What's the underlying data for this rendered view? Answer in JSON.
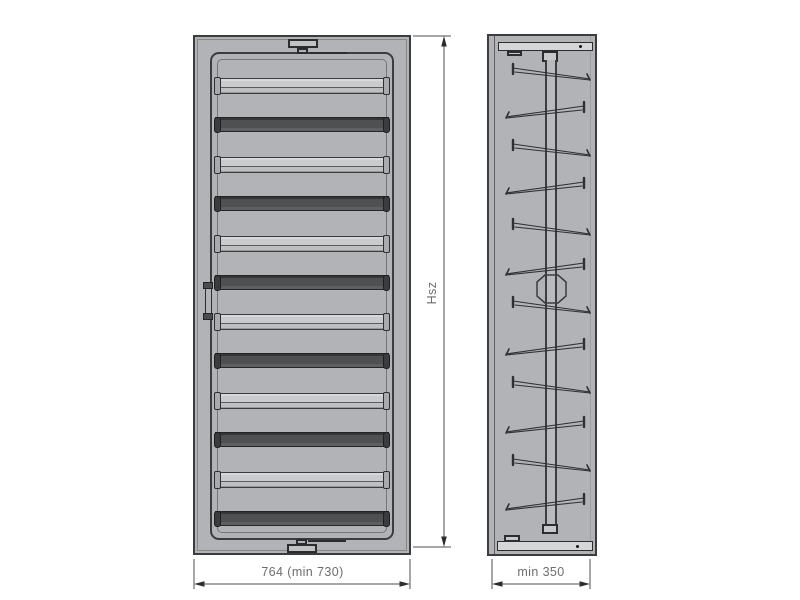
{
  "drawing": {
    "type": "technical-drawing",
    "views": {
      "front": {
        "name": "front view",
        "slat_count": 12
      },
      "side": {
        "name": "side view",
        "bracket_count": 12
      }
    },
    "labels": {
      "width": "764 (min 730)",
      "height": "Hsz",
      "depth": "min 350"
    },
    "colors": {
      "background": "#ffffff",
      "body": "#b1b3b6",
      "outline": "#3a3c3e",
      "light_slat": "#c9cbcd",
      "dark_slat": "#4e5052",
      "dimension_line": "#4d4f52",
      "label_text": "#6b6d70"
    },
    "front_view": {
      "slats": [
        {
          "y": 43,
          "type": "light"
        },
        {
          "y": 82,
          "type": "dark"
        },
        {
          "y": 122,
          "type": "light"
        },
        {
          "y": 161,
          "type": "dark"
        },
        {
          "y": 201,
          "type": "light"
        },
        {
          "y": 240,
          "type": "dark"
        },
        {
          "y": 279,
          "type": "light"
        },
        {
          "y": 318,
          "type": "dark"
        },
        {
          "y": 358,
          "type": "light"
        },
        {
          "y": 397,
          "type": "dark"
        },
        {
          "y": 437,
          "type": "light"
        },
        {
          "y": 476,
          "type": "dark"
        }
      ]
    },
    "side_view": {
      "brackets": [
        {
          "y": 33,
          "dir": "lr"
        },
        {
          "y": 71,
          "dir": "rl"
        },
        {
          "y": 109,
          "dir": "lr"
        },
        {
          "y": 147,
          "dir": "rl"
        },
        {
          "y": 188,
          "dir": "lr"
        },
        {
          "y": 228,
          "dir": "rl"
        },
        {
          "y": 266,
          "dir": "lr"
        },
        {
          "y": 308,
          "dir": "rl"
        },
        {
          "y": 346,
          "dir": "lr"
        },
        {
          "y": 386,
          "dir": "rl"
        },
        {
          "y": 424,
          "dir": "lr"
        },
        {
          "y": 463,
          "dir": "rl"
        }
      ]
    }
  }
}
